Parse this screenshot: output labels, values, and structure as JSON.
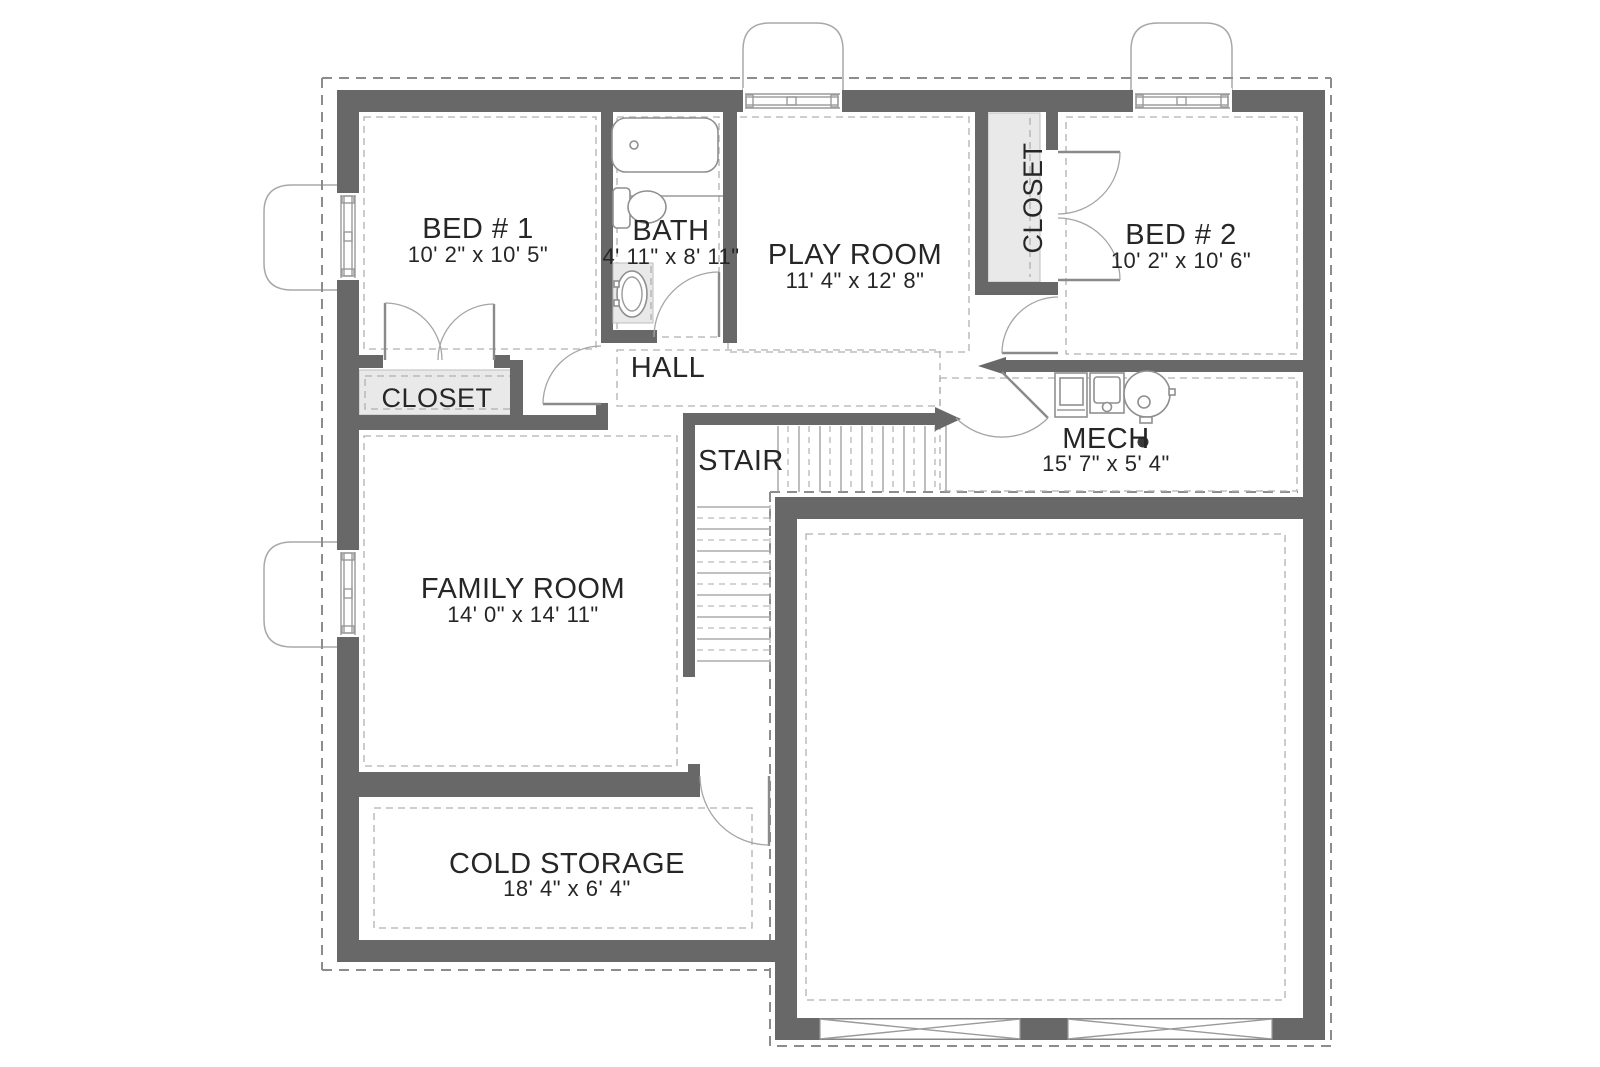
{
  "title": "Basement floor plan",
  "rooms": {
    "bed1": {
      "name": "BED # 1",
      "dims": "10' 2\" x 10' 5\""
    },
    "bath": {
      "name": "BATH",
      "dims": "4' 11\" x 8' 11\""
    },
    "playroom": {
      "name": "PLAY ROOM",
      "dims": "11' 4\" x 12' 8\""
    },
    "bed2": {
      "name": "BED # 2",
      "dims": "10' 2\" x 10' 6\""
    },
    "bed2_closet": {
      "name": "CLOSET"
    },
    "bed1_closet": {
      "name": "CLOSET"
    },
    "hall": {
      "name": "HALL"
    },
    "stair": {
      "name": "STAIR"
    },
    "mech": {
      "name": "MECH",
      "dims": "15' 7\" x 5' 4\""
    },
    "family": {
      "name": "FAMILY ROOM",
      "dims": "14' 0\" x 14' 11\""
    },
    "cold": {
      "name": "COLD STORAGE",
      "dims": "18' 4\" x 6' 4\""
    }
  },
  "colors": {
    "wall": "#686868",
    "closet_fill": "#e9e9e9",
    "fixture_line": "#8f8f8f",
    "footing_dash": "#8c8c8c",
    "inner_dash": "#b0b0b0",
    "text": "#262626",
    "background": "#ffffff"
  }
}
